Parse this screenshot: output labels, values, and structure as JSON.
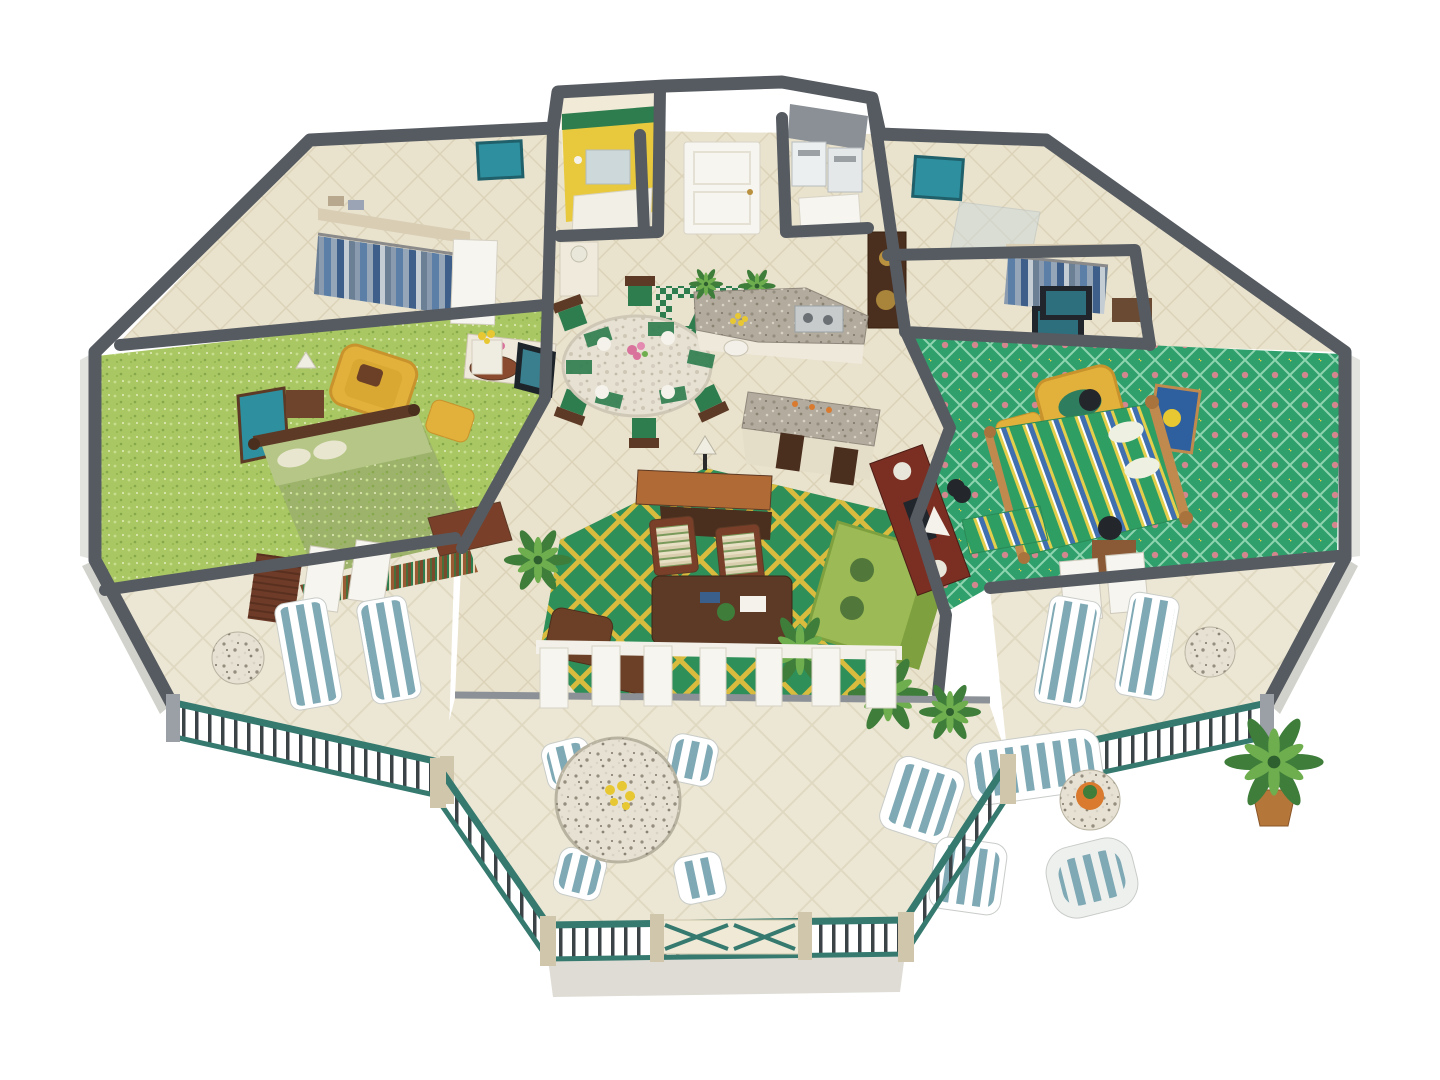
{
  "meta": {
    "title": "3D cutaway floor plan of a two-bedroom resort suite",
    "render_style": "isometric dollhouse view"
  },
  "scene": {
    "master_bedroom": "Master bedroom",
    "master_closet": "Walk-in closet",
    "master_bath": "Master bathroom / dressing area",
    "yellow_bath": "Yellow bathroom",
    "entry": "Entry foyer",
    "laundry": "Laundry closet",
    "kitchen": "Kitchen with granite bar",
    "dining": "Dining area",
    "living": "Living room",
    "guest_bedroom": "Second bedroom",
    "guest_bath": "Second bathroom",
    "guest_closet": "Second closet",
    "left_balcony": "Left balcony",
    "right_balcony": "Right balcony",
    "terrace": "Main terrace"
  },
  "colors": {
    "background": "#ffffff",
    "wall_dark": "#565b61",
    "wall_mid": "#9aa0a5",
    "wall_face": "#efe9d6",
    "wall_exterior": "#d9d9d4",
    "floor_tile": "#e9e2cd",
    "tile_line": "#dbd2b8",
    "terrace_tile": "#ece6d4",
    "carpet_master": "#a9c763",
    "carpet_living": "#2f8f58",
    "lattice_gold": "#d9bb3e",
    "carpet_guest": "#2fa06b",
    "guest_dot_pink": "#d4868e",
    "granite": "#b3ac9e",
    "marble": "#e6e1d3",
    "wood_dark": "#5d3a26",
    "wood_red": "#8a4a2f",
    "wood_light": "#c08a4e",
    "chair_yellow": "#e2b13c",
    "sofa_green": "#9cba55",
    "ottoman_brown": "#6b4027",
    "plant_green": "#3e7d3a",
    "plant_light": "#6fae4e",
    "pot_terracotta": "#b5763a",
    "railing_teal": "#35796f",
    "baluster_dark": "#3c4347",
    "stripe_blue": "#7fa9b4",
    "stripe_white": "#ffffff",
    "bed_stripe_green": "#2f9e63",
    "bed_stripe_yellow": "#e3cf4b",
    "bed_stripe_blue": "#3f6fae",
    "door_white": "#f6f5f0",
    "bath_yellow": "#e8c93e",
    "rug_green": "#2e7d4f",
    "art_teal": "#2e8f9e",
    "flower_pink": "#d9739c",
    "flower_yellow": "#e8c832",
    "accent_orange": "#d97a2e"
  }
}
